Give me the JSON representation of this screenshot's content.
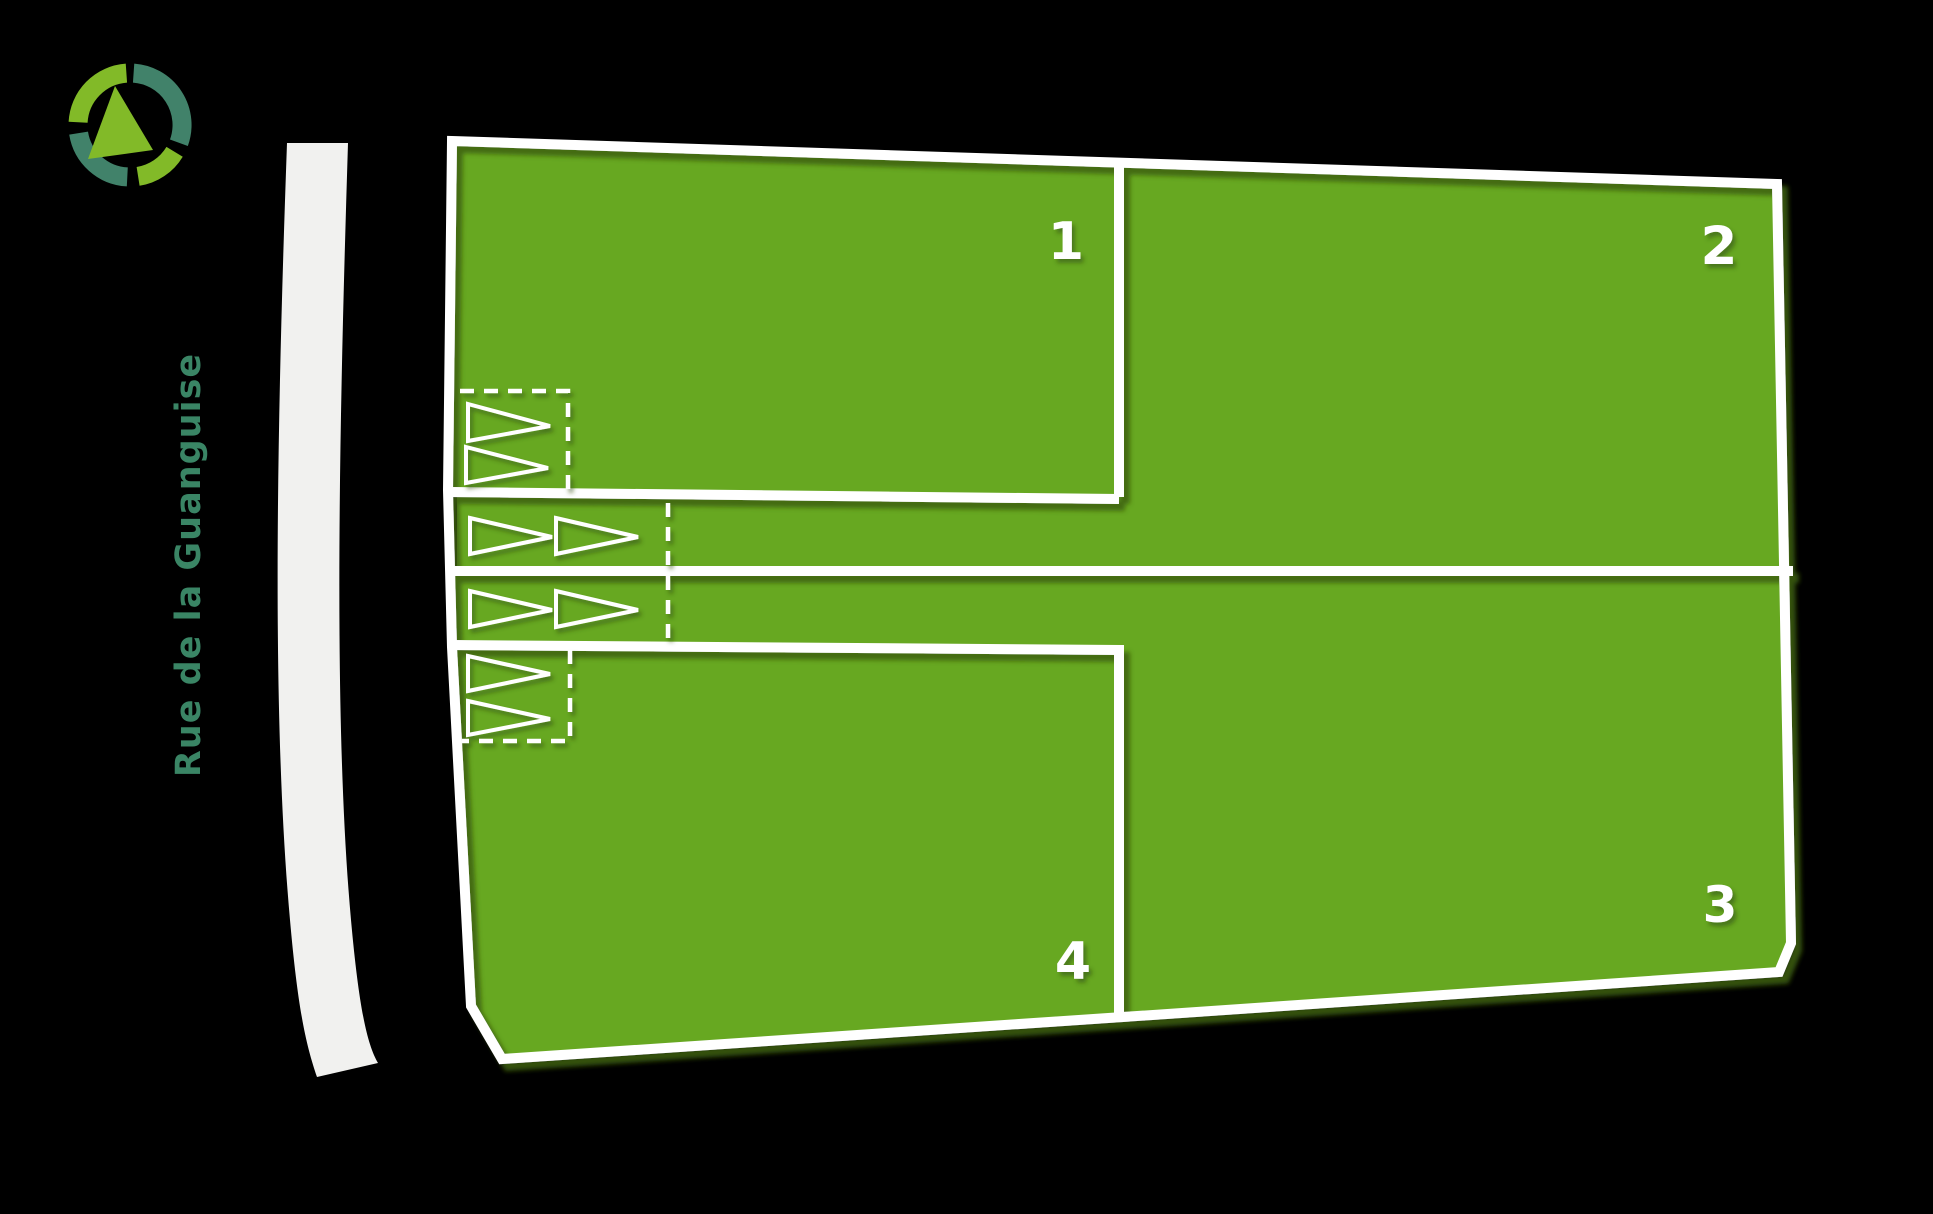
{
  "canvas": {
    "width": 1933,
    "height": 1214,
    "background": "#000000"
  },
  "street": {
    "name": "Rue de la Guanguise",
    "text_color": "#3a8565",
    "road_color": "#f1f1ef"
  },
  "compass": {
    "icon": "compass-north-icon",
    "light_color": "#82ba28",
    "dark_color": "#41826a"
  },
  "colors": {
    "plot_fill": "#67a821",
    "plot_border": "#ffffff",
    "border_shadow": "#3c5e0e",
    "arrow_stroke": "#ffffff",
    "label_color": "#ffffff"
  },
  "plots": [
    {
      "id": "plot-1",
      "label": "1"
    },
    {
      "id": "plot-2",
      "label": "2"
    },
    {
      "id": "plot-3",
      "label": "3"
    },
    {
      "id": "plot-4",
      "label": "4"
    }
  ]
}
